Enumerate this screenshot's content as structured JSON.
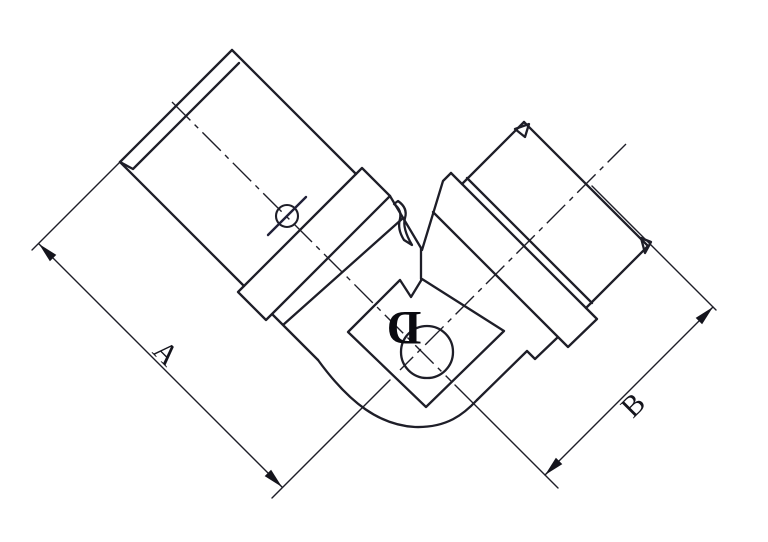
{
  "drawing": {
    "background": "#ffffff",
    "line_color": "#1e1e28",
    "labels": {
      "dim_a": "A",
      "dim_b": "B",
      "bore_d": "D"
    }
  }
}
